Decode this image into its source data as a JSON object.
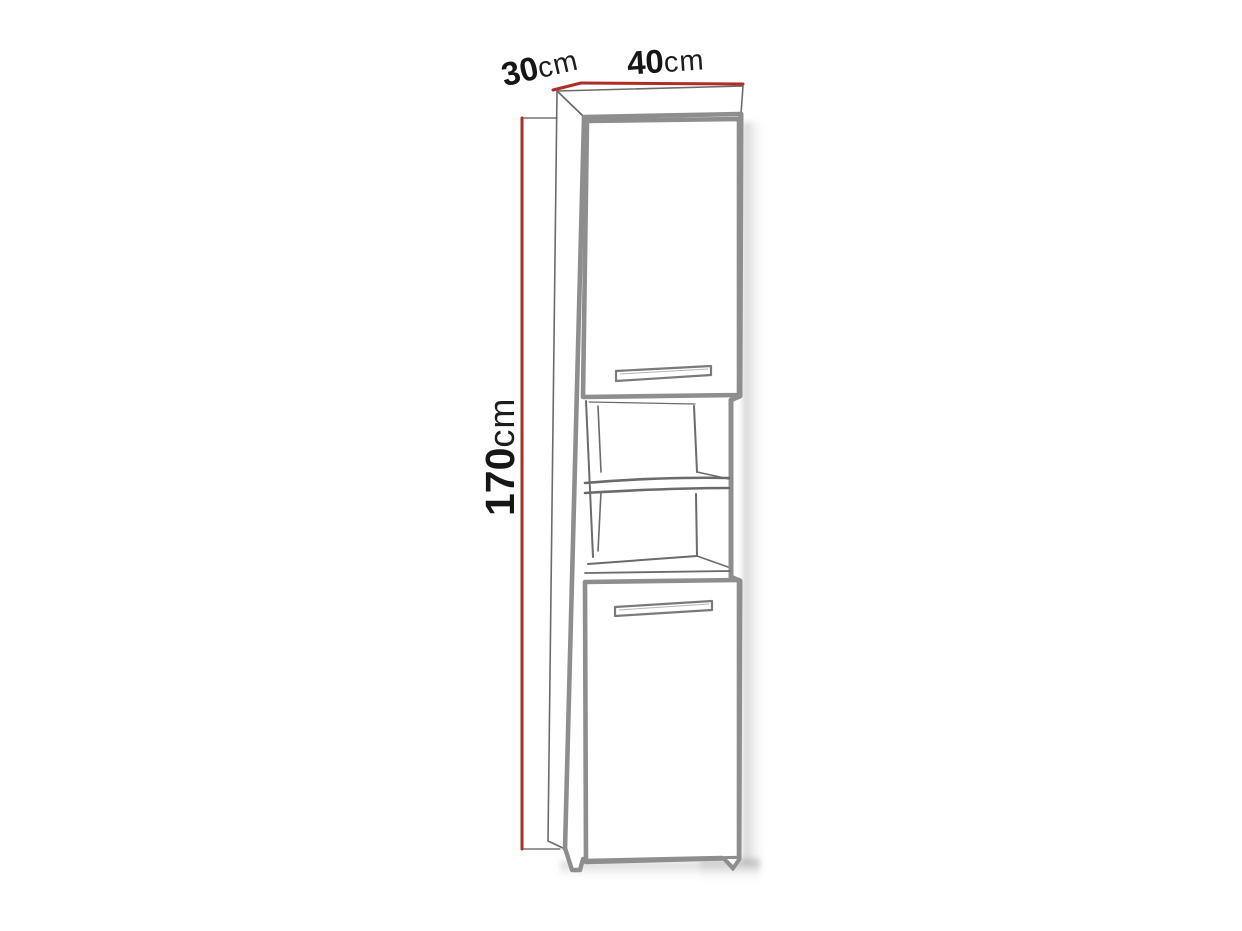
{
  "diagram": {
    "title": "tall-cabinet-dimension-drawing",
    "dimensions": {
      "depth": {
        "value": "30",
        "unit": "cm"
      },
      "width": {
        "value": "40",
        "unit": "cm"
      },
      "height": {
        "value": "170",
        "unit": "cm"
      }
    },
    "colors": {
      "dimension_line": "#b02c26",
      "outline_thick": "#8e8e8e",
      "outline_thin": "#6b6b6b",
      "text": "#161616",
      "background": "#ffffff"
    },
    "parts": {
      "top_door": "top-door",
      "top_door_handle": "recessed-handle",
      "open_niche": "open-shelf-niche",
      "shelf": "middle-shelf",
      "bottom_door": "bottom-door",
      "bottom_door_handle": "recessed-handle",
      "left_foot": "left-foot",
      "right_foot": "right-foot"
    }
  }
}
